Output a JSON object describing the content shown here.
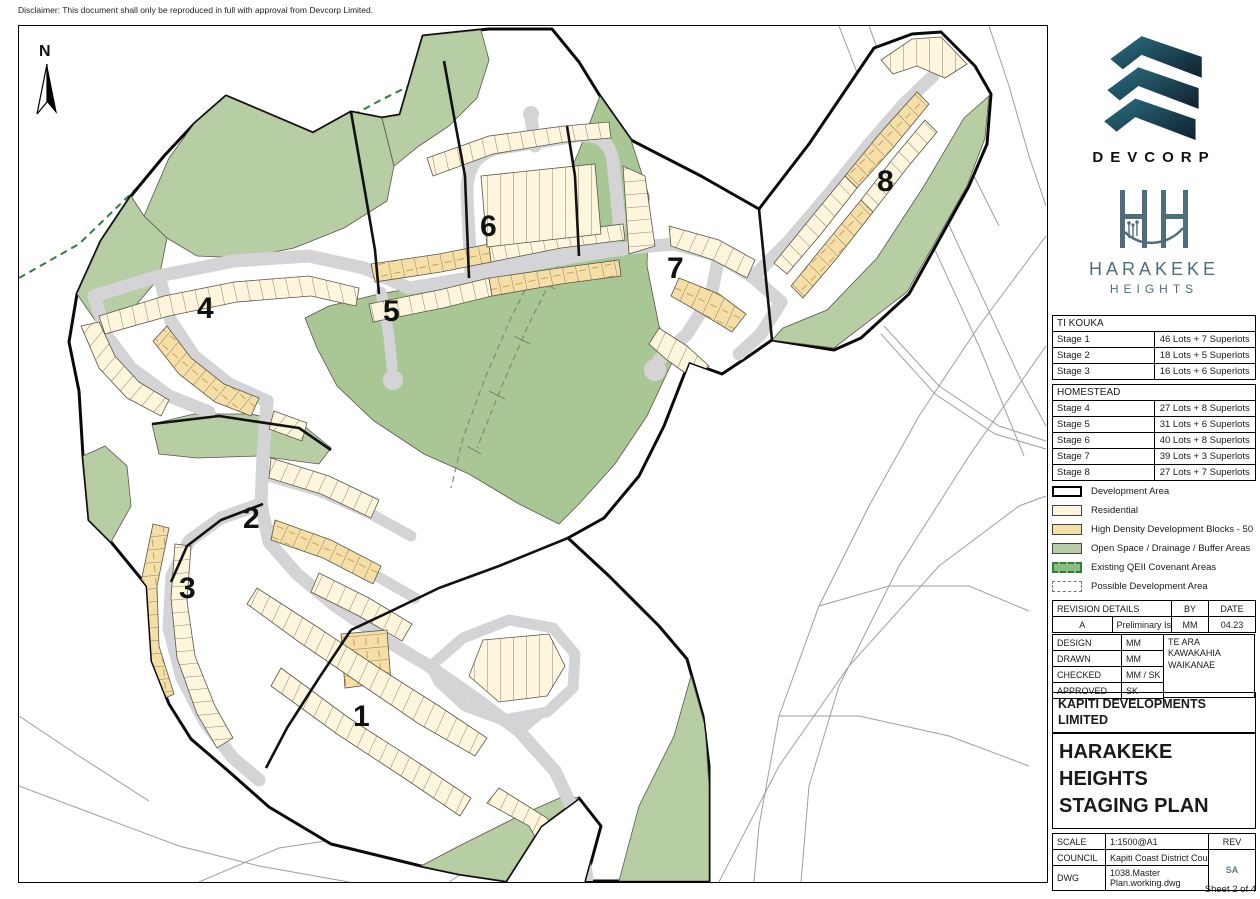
{
  "disclaimer": "Disclaimer: This document shall only be reproduced in full with approval from Devcorp Limited.",
  "map": {
    "north_label": "N",
    "stage_labels": [
      "1",
      "2",
      "3",
      "4",
      "5",
      "6",
      "7",
      "8"
    ]
  },
  "branding": {
    "devcorp_name": "DEVCORP",
    "project_line1": "HARAKEKE",
    "project_line2": "HEIGHTS"
  },
  "tables": {
    "ti_kouka": {
      "title": "TI KOUKA",
      "rows": [
        {
          "stage": "Stage 1",
          "lots": "46 Lots + 7 Superlots"
        },
        {
          "stage": "Stage 2",
          "lots": "18 Lots + 5 Superlots"
        },
        {
          "stage": "Stage 3",
          "lots": "16 Lots + 6 Superlots"
        }
      ]
    },
    "homestead": {
      "title": "HOMESTEAD",
      "rows": [
        {
          "stage": "Stage 4",
          "lots": "27 Lots + 8 Superlots"
        },
        {
          "stage": "Stage 5",
          "lots": "31 Lots + 6 Superlots"
        },
        {
          "stage": "Stage 6",
          "lots": "40 Lots + 8 Superlots"
        },
        {
          "stage": "Stage 7",
          "lots": "39 Lots + 3 Superlots"
        },
        {
          "stage": "Stage 8",
          "lots": "27 Lots + 7 Superlots"
        }
      ]
    }
  },
  "legend": {
    "items": [
      {
        "label": "Development Area"
      },
      {
        "label": "Residential"
      },
      {
        "label": "High Density Development Blocks - 50"
      },
      {
        "label": "Open Space / Drainage / Buffer Areas"
      },
      {
        "label": "Existing QEII Covenant Areas"
      },
      {
        "label": "Possible Development Area"
      }
    ]
  },
  "revision": {
    "title": "REVISION DETAILS",
    "by_header": "BY",
    "date_header": "DATE",
    "rows": [
      {
        "rev": "A",
        "desc": "Preliminary Issue",
        "by": "MM",
        "date": "04.23"
      }
    ]
  },
  "approvals": {
    "rows": [
      {
        "label": "DESIGN",
        "value": "MM"
      },
      {
        "label": "DRAWN",
        "value": "MM"
      },
      {
        "label": "CHECKED",
        "value": "MM / SK"
      },
      {
        "label": "APPROVED",
        "value": "SK"
      }
    ],
    "location": "TE ARA KAWAKAHIA WAIKANAE"
  },
  "title_block": {
    "client": "KAPITI DEVELOPMENTS LIMITED",
    "line1": "HARAKEKE",
    "line2": "HEIGHTS",
    "line3": "STAGING PLAN"
  },
  "drawing_info": {
    "scale_label": "SCALE",
    "scale": "1:1500@A1",
    "council_label": "COUNCIL",
    "council": "Kapiti Coast District Council",
    "dwg_label": "DWG",
    "dwg": "1038.Master Plan.working.dwg",
    "rev_label": "REV",
    "rev": "SA"
  },
  "footer": {
    "sheet": "Sheet 2 of 4"
  },
  "colors": {
    "road": "#d4d4d7",
    "residential": "#fdf5dc",
    "high_density": "#f6dfa6",
    "open_space": "#b7cda4",
    "qeii_green": "#2f7f3f",
    "boundary": "#111111",
    "devcorp_teal": "#1d6273",
    "logo_slate": "#4e6e7e",
    "rev_slate": "#5b7b8c"
  }
}
